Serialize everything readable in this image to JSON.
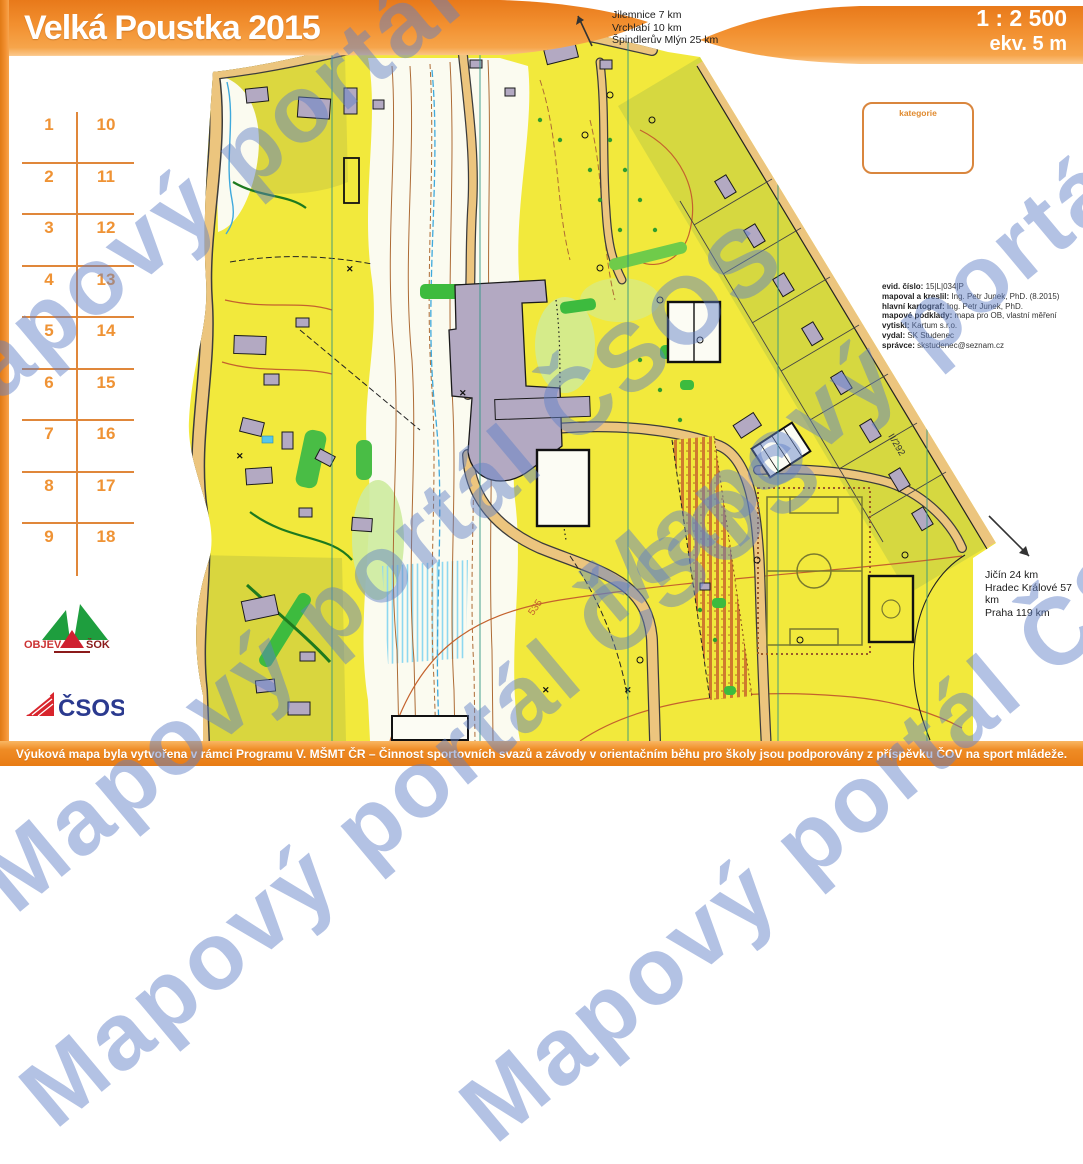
{
  "banner": {
    "title": "Velká Poustka 2015",
    "scale": "1 : 2 500",
    "equidistance": "ekv. 5 m"
  },
  "directions_top": {
    "lines": [
      "Jilemnice 7 km",
      "Vrchlabí 10 km",
      "Špindlerův Mlýn 25 km"
    ]
  },
  "directions_bottom": {
    "lines": [
      "Jičín 24 km",
      "Hradec Králové 57 km",
      "Praha 119 km"
    ]
  },
  "control_card": {
    "rows": [
      {
        "left": "1",
        "right": "10"
      },
      {
        "left": "2",
        "right": "11"
      },
      {
        "left": "3",
        "right": "12"
      },
      {
        "left": "4",
        "right": "13"
      },
      {
        "left": "5",
        "right": "14"
      },
      {
        "left": "6",
        "right": "15"
      },
      {
        "left": "7",
        "right": "16"
      },
      {
        "left": "8",
        "right": "17"
      },
      {
        "left": "9",
        "right": "18"
      }
    ]
  },
  "kategorie_label": "kategorie",
  "credits": {
    "lines": [
      {
        "label": "evid. číslo:",
        "value": " 15|L|034|P"
      },
      {
        "label": "mapoval a kreslil:",
        "value": " Ing. Petr Junek, PhD. (8.2015)"
      },
      {
        "label": "hlavní kartograf:",
        "value": " Ing. Petr Junek, PhD."
      },
      {
        "label": "mapové podklady:",
        "value": " mapa pro OB, vlastní měření"
      },
      {
        "label": "vytiskl:",
        "value": " Kartum s.r.o."
      },
      {
        "label": "vydal:",
        "value": " SK Studenec"
      },
      {
        "label": "správce:",
        "value": " skstudenec@seznam.cz"
      }
    ]
  },
  "logos": {
    "objev": "OBJEV",
    "sok": "ŠOK",
    "csos": "ČSOS"
  },
  "footer": {
    "text": "Výuková mapa byla vytvořena v rámci Programu V. MŠMT ČR – Činnost sportovních svazů a závody v orientačním běhu pro školy jsou podporovány z příspěvku ČOV na sport mládeže."
  },
  "watermark": {
    "text": "Mapový portál ČSOS"
  },
  "map_labels": {
    "contour": "535",
    "road": "II/292"
  },
  "colors": {
    "banner_orange": "#ef8b26",
    "map_yellow": "#f2e93c",
    "map_olive": "#d8d73f",
    "building_gray": "#b3a9c2",
    "road_sand": "#ecc57e",
    "green": "#3dbb3e",
    "contour_brown": "#c4622d",
    "water_blue": "#3fa9dc",
    "watermark_blue": "#617fc6",
    "card_orange": "#e0873a"
  }
}
